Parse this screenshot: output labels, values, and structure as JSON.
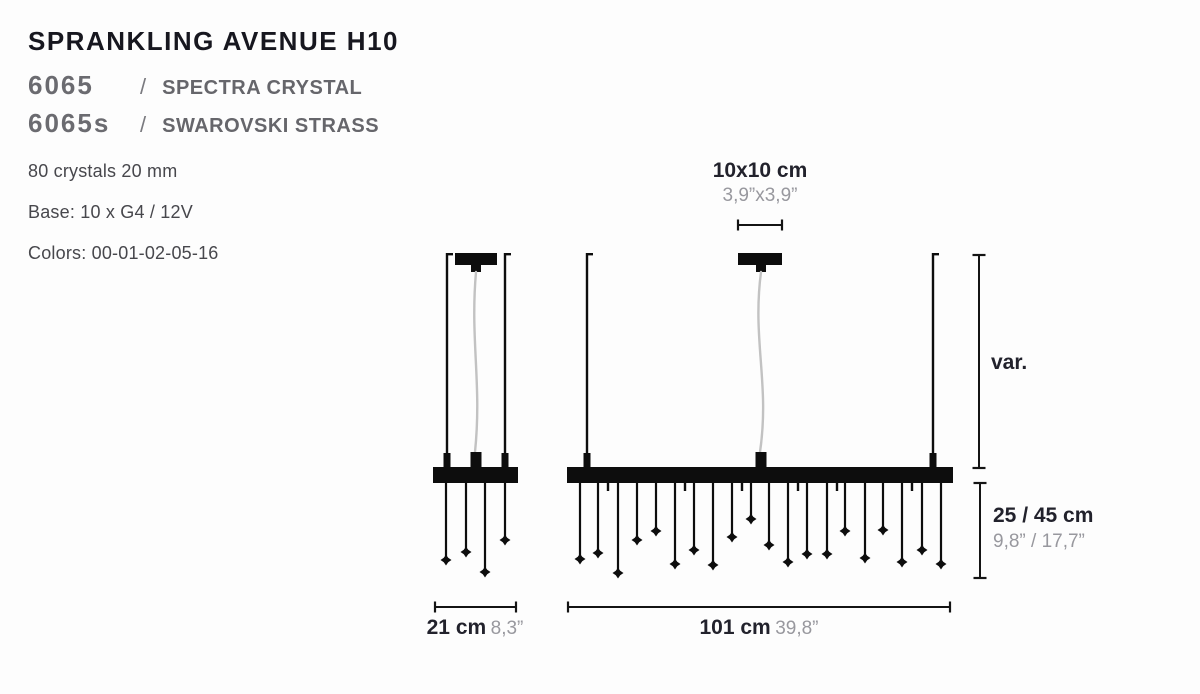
{
  "product": {
    "title": "SPRANKLING AVENUE H10",
    "variants": [
      {
        "code": "6065",
        "sep": "/",
        "name": "SPECTRA CRYSTAL"
      },
      {
        "code": "6065s",
        "sep": "/",
        "name": "SWAROVSKI STRASS"
      }
    ],
    "specs": [
      "80 crystals 20 mm",
      "Base: 10 x G4 / 12V",
      "Colors: 00-01-02-05-16"
    ]
  },
  "dimensions": {
    "canopy": {
      "metric": "10x10 cm",
      "imperial": "3,9”x3,9”"
    },
    "suspension": {
      "label": "var."
    },
    "drop": {
      "metric": "25 / 45 cm",
      "imperial": "9,8” / 17,7”"
    },
    "small_width": {
      "metric": "21 cm",
      "imperial": "8,3”"
    },
    "large_width": {
      "metric": "101 cm",
      "imperial": "39,8”"
    }
  },
  "colors": {
    "ink": "#0d0d0d",
    "dim_line": "#141414",
    "cable": "#c2c2c2",
    "text_dark": "#22222c",
    "text_gray": "#98989e",
    "background": "#fdfdfd"
  },
  "diagram": {
    "ceiling_y": 253,
    "bar_top_y": 467,
    "bar_bottom_y": 483,
    "canopy_height": 12,
    "fixtures": [
      {
        "name": "small-fixture",
        "canopy": {
          "x1": 455,
          "x2": 497
        },
        "rods": [
          447,
          505
        ],
        "cable_x": 476,
        "cable_amplitude": 6,
        "bar": {
          "x1": 433,
          "x2": 518
        },
        "stubs": [],
        "drops": [
          [
            446,
            560
          ],
          [
            466,
            552
          ],
          [
            485,
            572
          ],
          [
            505,
            540
          ]
        ]
      },
      {
        "name": "large-fixture",
        "canopy": {
          "x1": 738,
          "x2": 782
        },
        "rods": [
          587,
          933
        ],
        "cable_x": 761,
        "cable_amplitude": 9,
        "bar": {
          "x1": 567,
          "x2": 953
        },
        "stubs": [
          608,
          685,
          742,
          798,
          837,
          912
        ],
        "drops": [
          [
            580,
            559
          ],
          [
            598,
            553
          ],
          [
            618,
            573
          ],
          [
            637,
            540
          ],
          [
            656,
            531
          ],
          [
            675,
            564
          ],
          [
            694,
            550
          ],
          [
            713,
            565
          ],
          [
            732,
            537
          ],
          [
            751,
            519
          ],
          [
            769,
            545
          ],
          [
            788,
            562
          ],
          [
            807,
            554
          ],
          [
            827,
            554
          ],
          [
            845,
            531
          ],
          [
            865,
            558
          ],
          [
            883,
            530
          ],
          [
            902,
            562
          ],
          [
            922,
            550
          ],
          [
            941,
            564
          ]
        ]
      }
    ],
    "dim_lines": {
      "canopy_line": {
        "type": "h",
        "x1": 738,
        "x2": 782,
        "y": 225
      },
      "var_line": {
        "type": "v",
        "x": 979,
        "y1": 255,
        "y2": 468
      },
      "drop_line": {
        "type": "v",
        "x": 980,
        "y1": 483,
        "y2": 578
      },
      "small_width_line": {
        "type": "h",
        "x1": 435,
        "x2": 516,
        "y": 607
      },
      "large_width_line": {
        "type": "h",
        "x1": 568,
        "x2": 950,
        "y": 607
      }
    }
  }
}
